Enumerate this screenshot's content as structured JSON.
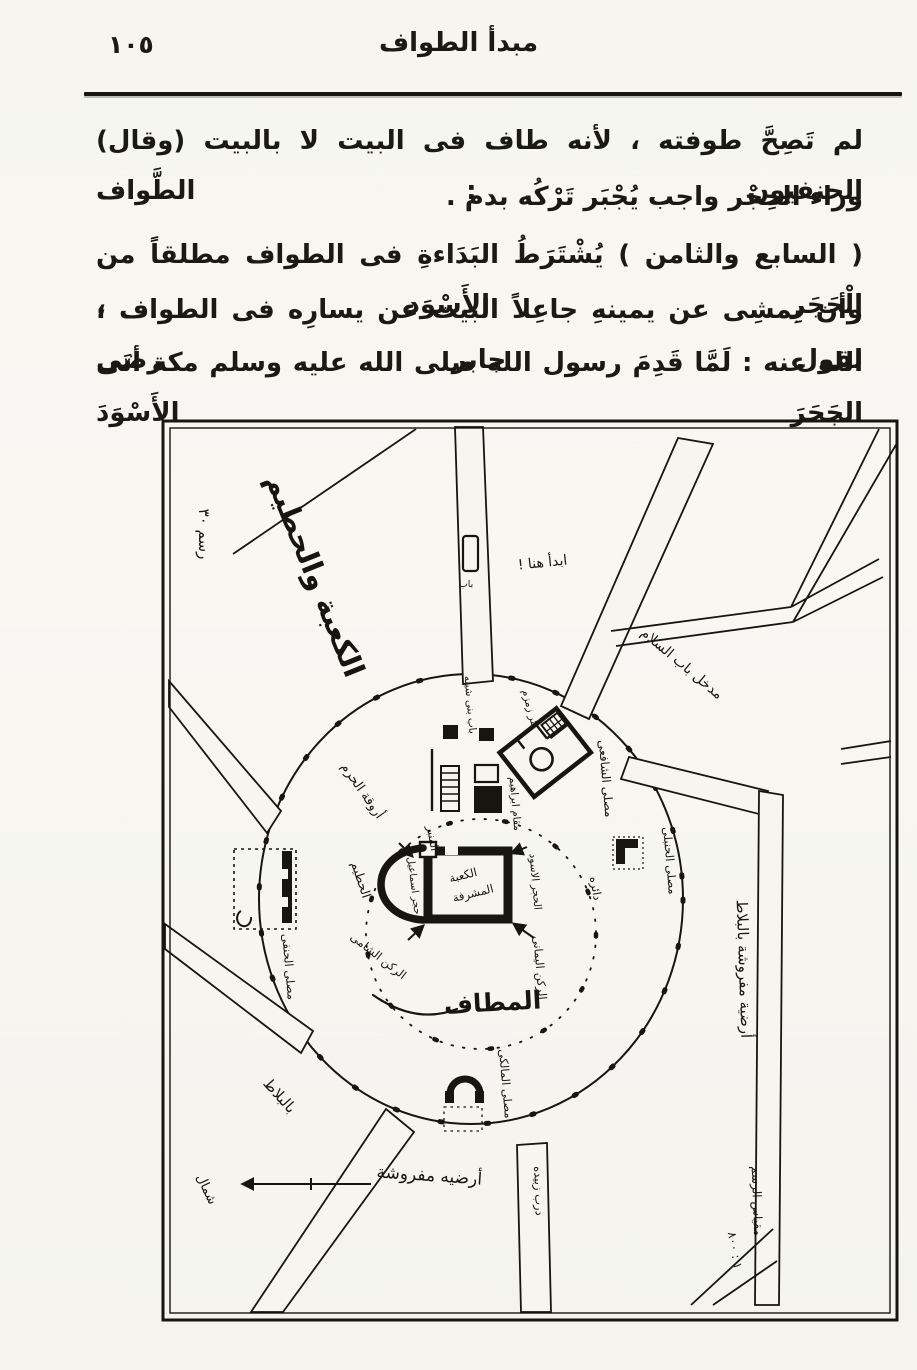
{
  "page": {
    "page_number": "١٠٥",
    "header_title": "مبدأ الطواف",
    "paragraph1": {
      "line1": "لم تَصِحَّ طوفته ، لأنه طاف فى البيت لا بالبيت (وقال) الحنفيون : الطَّواف",
      "line2": "وراء الحِجْر واجب يُجْبَر تَرْكُه بدم ."
    },
    "paragraph2": {
      "line1": "( السابع والثامن ) يُشْتَرَطُ البَدَاءةِ فى الطواف مطلقاً من الْحَجَرِ الأَسْوَد ،",
      "line2": "وأن يمشِى عن يمينهِ جاعِلاً البيت عن يسارِه فى الطواف ، لقول جابر رضى",
      "line3": "الله عنه : لَمَّا قَدِمَ رسول الله صلى الله عليه وسلم مكة أتَى الجَحَرَ الأَسْوَدَ"
    }
  },
  "map": {
    "figure_no": "رسم ٣٠",
    "title": "الكعبة والحطيم",
    "labels": {
      "start_note": "ابدأ هنا !",
      "salam_entrance": "مدخل باب السلام",
      "gate": "باب",
      "bab_bani_shayba": "باب بنى شيبه",
      "zamzam": "بئر زمزم",
      "shafii": "مصلى الشافعى",
      "minbar": "المنبر",
      "maqam": "مقام ابراهيم",
      "black_stone": "الحجر الاسود",
      "kaaba_line1": "الكعبة",
      "kaaba_line2": "المشرفة",
      "hijr": "حجر اسماعيل",
      "hatim": "الحطيم",
      "rukn_shami": "الركن الشامى",
      "rukn_yamani": "الركن اليمانى",
      "daira": "دائره",
      "mataf": "المطاف",
      "arcade": "أروقة الحرم",
      "hanafi": "مصلى الحنفى",
      "hanbali": "مصلى الحنبلى",
      "maliki": "مصلى المالكى",
      "paved_right": "أرضية مفروشة بالبلاط",
      "paved_bottom": "أرضيه مفروشة",
      "paved_tiles": "بالبلاط",
      "street": "درب زبيده",
      "north": "شمال",
      "scale_label": "مقياس الرسم",
      "scale_value": "١ : ٨٠٠"
    },
    "ink_color": "#17150f",
    "paper_color": "#f6f5f0"
  }
}
